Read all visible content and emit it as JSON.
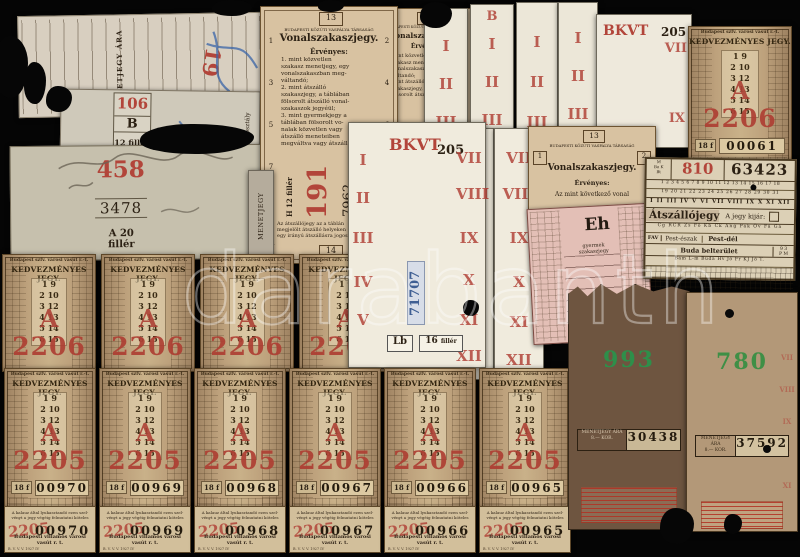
{
  "photo": {
    "background": "#050505",
    "watermark": "darabanth"
  },
  "t19": {
    "number": "19",
    "fare_label": "MENETJEGY ÁRA 60 f."
  },
  "t106": {
    "number": "106",
    "class_letter": "B",
    "fare": "12 fillér",
    "serial": "01093",
    "side_label": "Menetjegy II. osztály"
  },
  "t458": {
    "number": "458",
    "serial": "3478",
    "fare": "A 20 fillér",
    "side_label": "MENETJEGY"
  },
  "grey_stub": {
    "label": "MENETJEGY"
  },
  "t191": {
    "top_number": "13",
    "company": "BUDAPESTI KÖZÚTI VASPÁLYA TÁRSASÁG",
    "title": "Vonalszakaszjegy.",
    "valid_label": "Érvényes:",
    "body": "1. mint közvetlen\nszakasz menetjegy, egy\nvonalszakaszban meg-\nváltandó;\n2. mint átszálló\nszakaszjegy, a táblában\nfölsorolt átszálló vonal-\nszakaszok jegyéül;\n3. mint gyermekjegy a\ntáblában fölsorolt vo-\nnalak közvetlen vagy\nátszálló meneteiben\nmegváltva vagy átszállásra",
    "left_numbers": [
      "1",
      "3",
      "5",
      "7",
      "11"
    ],
    "right_numbers": [
      "2",
      "4",
      "6",
      "8"
    ],
    "fare": "H 12 fillér",
    "number": "191",
    "serial": "7962",
    "footnote": "Az átszállójegy az a táblán\nmegjelölt átszálló helyeken\negy irányú átszállásra jogosít.",
    "bottom_number": "14"
  },
  "vonal3": {
    "top_number": "13",
    "company": "BUDAPESTI KÖZÚTI VASPÁLYA TÁRSASÁG",
    "title": "Vonalszakaszjegy.",
    "valid_label": "Érvényes:",
    "body": "mint közvetlen\nszakasz menetjegy\nvonalszakaszban\nváltandó;\nmint átszálló\nszakaszjegy, a táblában\nfölsorolt átszálló vonal-"
  },
  "vonal2": {
    "top_number": "13",
    "company": "BUDAPESTI KÖZÚTI VASPÁLYA TÁRSASÁG",
    "title": "Vonalszakaszjegy.",
    "valid_label": "Érvényes:",
    "line": "Az mint következő vonal",
    "left_number": "1",
    "right_number": "2"
  },
  "strips": {
    "b_label": "B",
    "bkvt": "BKVT",
    "number": "205"
  },
  "shared": {
    "roman_top": [
      "I",
      "II",
      "III"
    ],
    "roman_bottom": [
      "VII",
      "VIII",
      "IX",
      "X",
      "XI",
      "XII"
    ]
  },
  "bkvt_center": {
    "brand": "BKVT",
    "number": "205",
    "serial": "71707",
    "class_code": "Lb",
    "fare_amount": "16",
    "fare_unit": "fillér",
    "left_romans": [
      "I",
      "II",
      "III",
      "IV",
      "V"
    ],
    "right_romans": [
      "VII",
      "VIII",
      "IX",
      "X",
      "XI",
      "XII"
    ]
  },
  "eh": {
    "code": "Eh",
    "label": "gyermek szakaszjegy"
  },
  "atszallo": {
    "corner": "M\nBa K\nBt",
    "number": "810",
    "serial": "63423",
    "days1": "1 2 3 4 5 6 7 8 9 10 11 12 13 14 15 16 17 18",
    "days2": "19 20 21 22 23 24 25 26 27 28 29 30 31",
    "months": "I II III IV V VI VII VIII IX X XI XII",
    "title": "Átszállójegy",
    "note": "A jegy kijár:",
    "codes1": "Cg RCR Zs Fö Kb Ck Ang Pák Öv Fá Ga",
    "fav": "FAV",
    "dest_north": "Pest-észak",
    "dest_south": "Pest-dél",
    "dest_buda": "Buda belterület",
    "corner2": "9 3\nP M",
    "codes2": "Bám L-m Buda Hv Jő Fr KJ Jő T."
  },
  "kedvezmenyes": {
    "company": "Budapest szfv. városi vasút r.-t.",
    "title": "KEDVEZMÉNYES JEGY.",
    "pairs": "1  9\n2  10\n3  12\n4  13\n5  14\n6  15",
    "letter": "A",
    "price_code": "18 f"
  },
  "row_2206": {
    "number": "2206",
    "items": [
      {},
      {},
      {},
      {}
    ]
  },
  "ticket_2206_topright": {
    "number": "2206",
    "serial": "00061"
  },
  "row_2205": {
    "number": "2205",
    "items": [
      {
        "serial": "00970"
      },
      {
        "serial": "00969"
      },
      {
        "serial": "00968"
      },
      {
        "serial": "00967"
      },
      {
        "serial": "00966"
      },
      {
        "serial": "00965"
      }
    ]
  },
  "stub_row": {
    "number": "2205",
    "top_text": "A kalauz által lyukasztandó ezen szel-\nvényt a jegy végéig felmutatni köteles",
    "company": "Budapesti villamos városi vasút r. t.",
    "print_code": "B. V. V. V. 1927 IV",
    "items": [
      {
        "serial": "00970"
      },
      {
        "serial": "00969"
      },
      {
        "serial": "00968"
      },
      {
        "serial": "00967"
      },
      {
        "serial": "00966"
      },
      {
        "serial": "00965"
      }
    ]
  },
  "t993": {
    "number": "993",
    "serial": "30438",
    "fare_label": "MENETJEGY ÁRA",
    "fare": "8.— KOR."
  },
  "t780": {
    "number": "780",
    "serial": "37592",
    "fare_label": "MENETJEGY ÁRA",
    "fare": "8.— KOR.",
    "romans": [
      "VII",
      "VIII",
      "IX",
      "X",
      "XI"
    ]
  }
}
